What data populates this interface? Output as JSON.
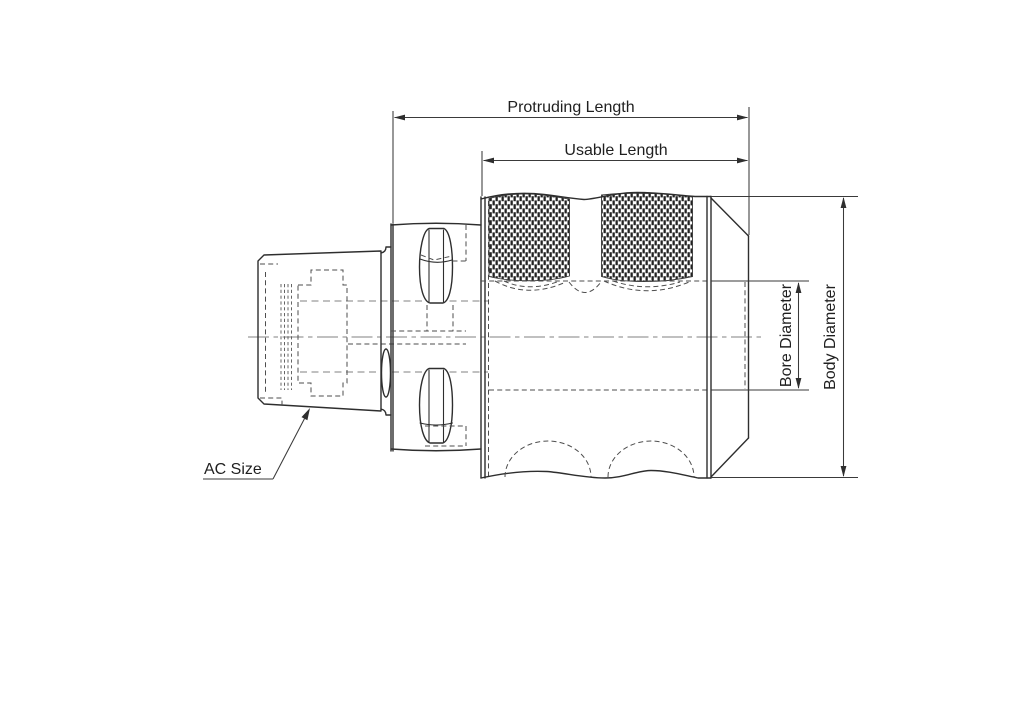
{
  "drawing": {
    "view": "tool-holder-side-view-technical-drawing",
    "labels": {
      "protruding_length": "Protruding Length",
      "usable_length": "Usable Length",
      "bore_diameter": "Bore Diameter",
      "body_diameter": "Body Diameter",
      "ac_size": "AC Size"
    },
    "colors": {
      "background": "#ffffff",
      "outline": "#2e2e2e",
      "hidden_line": "#4e4e4e",
      "center_line": "#9b9b9b",
      "dimension_line": "#3a3a3a",
      "text": "#1f1f1f"
    }
  }
}
